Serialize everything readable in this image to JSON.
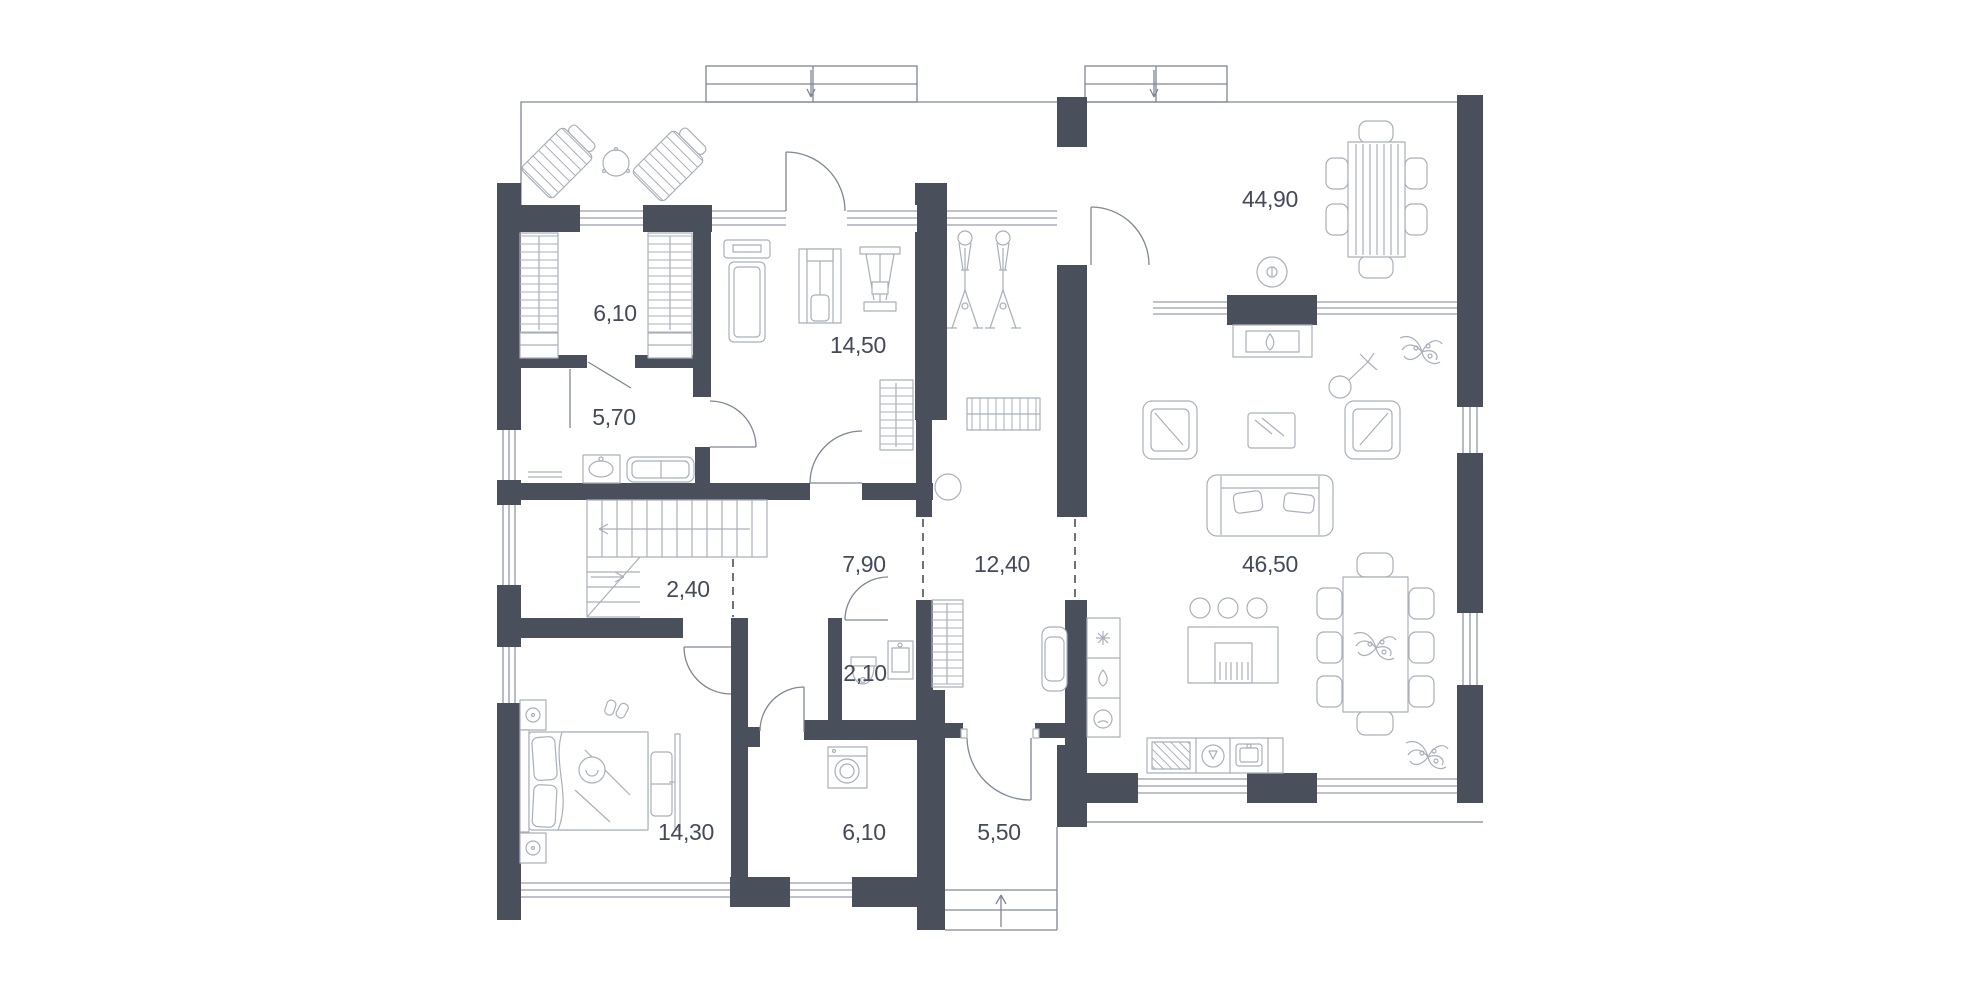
{
  "theme": {
    "wall": "#4a4f5c",
    "line": "#7f8696",
    "furn": "#a9afbb",
    "label": "#444a5a",
    "bg": "#ffffff"
  },
  "plan": {
    "type": "floor-plan",
    "rooms": [
      {
        "id": "dressing-room",
        "area": "6,10"
      },
      {
        "id": "bathroom",
        "area": "5,70"
      },
      {
        "id": "gym",
        "area": "14,50"
      },
      {
        "id": "dining-room",
        "area": "44,90"
      },
      {
        "id": "stair-hall",
        "area": "2,40"
      },
      {
        "id": "hallway",
        "area": "7,90"
      },
      {
        "id": "corridor",
        "area": "12,40"
      },
      {
        "id": "living-room",
        "area": "46,50"
      },
      {
        "id": "wc",
        "area": "2,10"
      },
      {
        "id": "bedroom",
        "area": "14,30"
      },
      {
        "id": "laundry-room",
        "area": "6,10"
      },
      {
        "id": "entry",
        "area": "5,50"
      }
    ],
    "icons": {
      "entrance_step_arrows": "arrow-down",
      "exit_step_arrow": "arrow-up",
      "stair_up_arrow": "arrow-left",
      "stair_turn_arrow": "arrow-right",
      "fridge_icon": "snowflake",
      "hob_icon": "flame",
      "oven_icon": "oven-dial",
      "fireplace_icon": "flame"
    }
  }
}
